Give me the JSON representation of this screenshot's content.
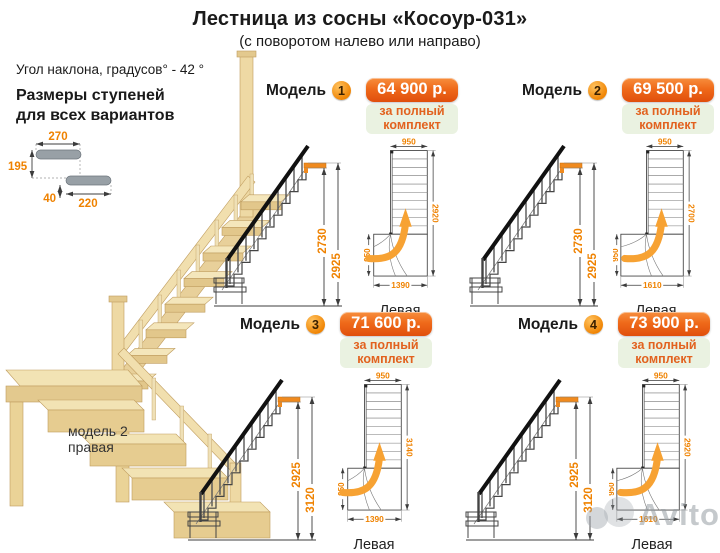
{
  "title": "Лестница из сосны «Косоур-031»",
  "subtitle": "(с поворотом налево или направо)",
  "left_panel": {
    "angle_text": "Угол наклона, градусов° - 42 °",
    "sizes_title_line1": "Размеры ступеней",
    "sizes_title_line2": "для всех вариантов",
    "step_dims": {
      "depth_top": "270",
      "rise": "195",
      "nose": "40",
      "depth_bottom": "220"
    },
    "photo_caption_line1": "модель 2",
    "photo_caption_line2": "правая"
  },
  "model_word": "Модель",
  "price_note_line1": "за полный",
  "price_note_line2": "комплект",
  "direction_label": "Левая",
  "models": [
    {
      "number": "1",
      "price": "64 900 р.",
      "side_inner": "2730",
      "side_outer": "2925",
      "plan_top": "950",
      "plan_right": "2920",
      "plan_left": "950",
      "plan_bottom": "1390"
    },
    {
      "number": "2",
      "price": "69 500 р.",
      "side_inner": "2730",
      "side_outer": "2925",
      "plan_top": "950",
      "plan_right": "2700",
      "plan_left": "950",
      "plan_bottom": "1610"
    },
    {
      "number": "3",
      "price": "71 600 р.",
      "side_inner": "2925",
      "side_outer": "3120",
      "plan_top": "950",
      "plan_right": "3140",
      "plan_left": "950",
      "plan_bottom": "1390"
    },
    {
      "number": "4",
      "price": "73 900 р.",
      "side_inner": "2925",
      "side_outer": "3120",
      "plan_top": "950",
      "plan_right": "2920",
      "plan_left": "950",
      "plan_bottom": "1610"
    }
  ],
  "watermark": "Avito",
  "colors": {
    "dim_orange": "#ef8200",
    "price_box_orange": "#ef6a1a",
    "note_green_bg": "#eaf2e1",
    "wood_light": "#f2e3b4",
    "wood_mid": "#e6cc90",
    "watermark_gray": "#9ba1a7"
  }
}
